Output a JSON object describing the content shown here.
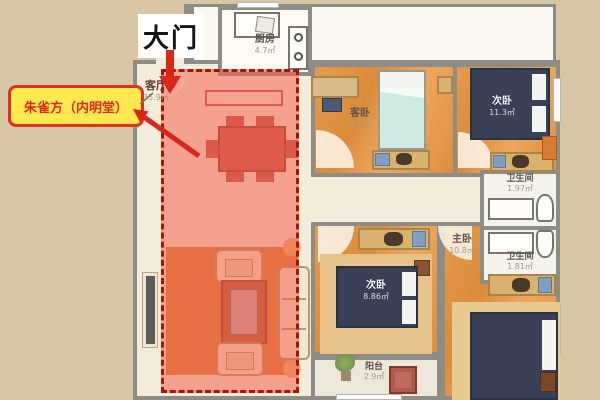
{
  "annotations": {
    "door_label": "大门",
    "fengshui_label": "朱雀方（内明堂）"
  },
  "colors": {
    "background": "#d9c6a4",
    "arrow": "#d8261a",
    "fengshui_box_bg": "#ffe94f",
    "fengshui_box_border": "#e03020",
    "overlay_fill": "rgba(243,92,74,0.52)",
    "overlay_border": "#a81503",
    "bedroom_floor": "#e0903f",
    "bed_navy": "#3a4157",
    "bed_cyan": "#cfe9e3"
  },
  "rooms": {
    "kitchen": {
      "name": "厨房",
      "area": "4.7㎡"
    },
    "living": {
      "name": "客厅",
      "area": "35.9㎡"
    },
    "guest_bedroom": {
      "name": "客卧",
      "area": "10.5㎡"
    },
    "second_bedroom_top": {
      "name": "次卧",
      "area": "11.3㎡"
    },
    "bathroom_top": {
      "name": "卫生间",
      "area": "1.97㎡"
    },
    "bathroom_bottom": {
      "name": "卫生间",
      "area": "1.81㎡"
    },
    "master_bedroom": {
      "name": "主卧",
      "area": "10.8㎡"
    },
    "second_bedroom_bottom": {
      "name": "次卧",
      "area": "8.86㎡"
    },
    "balcony": {
      "name": "阳台",
      "area": "2.9㎡"
    }
  }
}
